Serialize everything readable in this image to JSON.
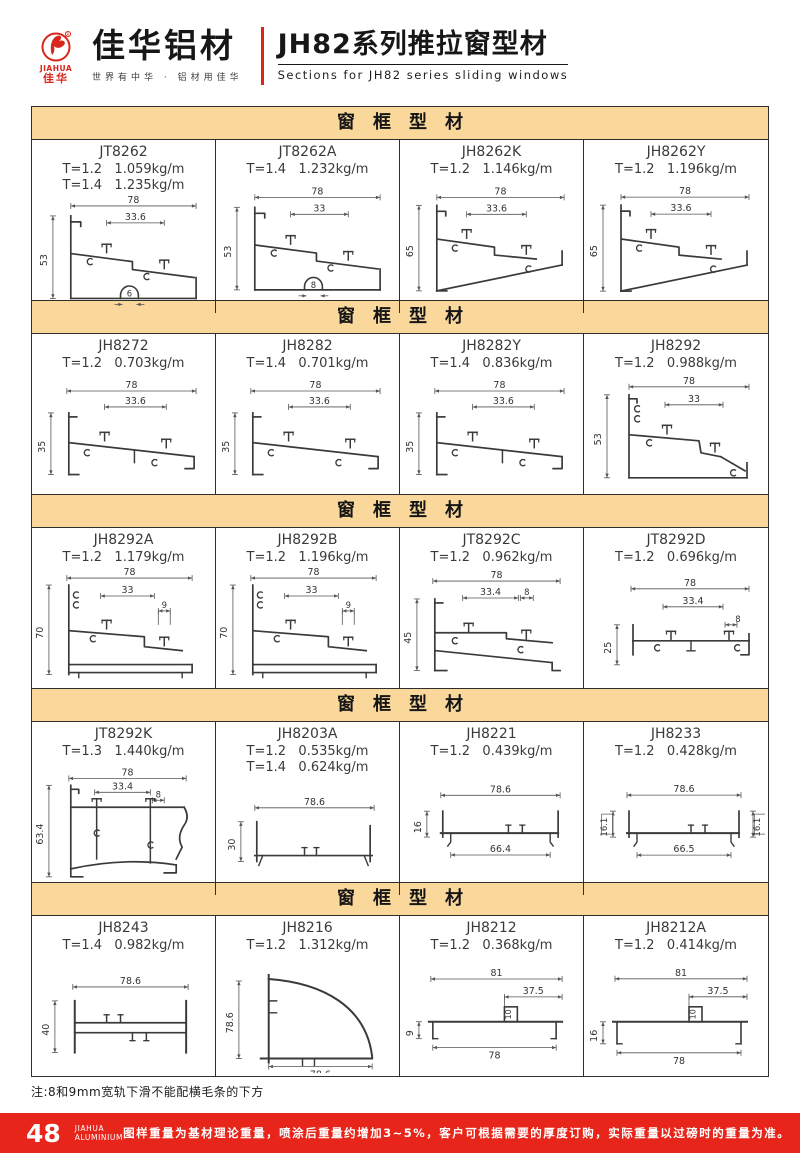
{
  "header": {
    "logo": {
      "mark": "JIAHUA",
      "seal": "佳华",
      "brand": "佳华铝材",
      "tagline": "世界有中华 · 铝材用佳华"
    },
    "title_cn": "JH82系列推拉窗型材",
    "title_en": "Sections for JH82 series sliding windows"
  },
  "sections": [
    {
      "banner": "窗框型材",
      "profiles": [
        {
          "model": "JT8262",
          "weights": [
            "T=1.2   1.059kg/m",
            "T=1.4   1.235kg/m"
          ],
          "shape": "sill53",
          "dims": {
            "w": "78",
            "inner": "33.6",
            "h": "53",
            "slot": "6"
          }
        },
        {
          "model": "JT8262A",
          "weights": [
            "T=1.4   1.232kg/m"
          ],
          "shape": "sill53",
          "dims": {
            "w": "78",
            "inner": "33",
            "h": "53",
            "slot": "8"
          }
        },
        {
          "model": "JH8262K",
          "weights": [
            "T=1.2   1.146kg/m"
          ],
          "shape": "frame65",
          "dims": {
            "w": "78",
            "inner": "33.6",
            "h": "65"
          }
        },
        {
          "model": "JH8262Y",
          "weights": [
            "T=1.2   1.196kg/m"
          ],
          "shape": "frame65",
          "dims": {
            "w": "78",
            "inner": "33.6",
            "h": "65"
          }
        }
      ]
    },
    {
      "banner": "窗框型材",
      "profiles": [
        {
          "model": "JH8272",
          "weights": [
            "T=1.2   0.703kg/m"
          ],
          "shape": "frame35",
          "dims": {
            "w": "78",
            "inner": "33.6",
            "h": "35",
            "stub": "1"
          }
        },
        {
          "model": "JH8282",
          "weights": [
            "T=1.4   0.701kg/m"
          ],
          "shape": "frame35",
          "dims": {
            "w": "78",
            "inner": "33.6",
            "h": "35"
          }
        },
        {
          "model": "JH8282Y",
          "weights": [
            "T=1.4   0.836kg/m"
          ],
          "shape": "frame35",
          "dims": {
            "w": "78",
            "inner": "33.6",
            "h": "35",
            "stub": "1"
          }
        },
        {
          "model": "JH8292",
          "weights": [
            "T=1.2   0.988kg/m"
          ],
          "shape": "frame53b",
          "dims": {
            "w": "78",
            "inner": "33",
            "h": "53"
          }
        }
      ]
    },
    {
      "banner": "窗框型材",
      "profiles": [
        {
          "model": "JH8292A",
          "weights": [
            "T=1.2   1.179kg/m"
          ],
          "shape": "frame70",
          "dims": {
            "w": "78",
            "inner": "33",
            "sub": "9",
            "h": "70"
          }
        },
        {
          "model": "JH8292B",
          "weights": [
            "T=1.2   1.196kg/m"
          ],
          "shape": "frame70",
          "dims": {
            "w": "78",
            "inner": "33",
            "sub": "9",
            "h": "70"
          }
        },
        {
          "model": "JT8292C",
          "weights": [
            "T=1.2   0.962kg/m"
          ],
          "shape": "frame45",
          "dims": {
            "w": "78",
            "inner": "33.4",
            "sub": "8",
            "h": "45"
          }
        },
        {
          "model": "JT8292D",
          "weights": [
            "T=1.2   0.696kg/m"
          ],
          "shape": "frame25",
          "dims": {
            "w": "78",
            "inner": "33.4",
            "sub": "8",
            "h": "25"
          }
        }
      ]
    },
    {
      "banner": "窗框型材",
      "profiles": [
        {
          "model": "JT8292K",
          "weights": [
            "T=1.3   1.440kg/m"
          ],
          "shape": "frame63",
          "dims": {
            "w": "78",
            "inner": "33.4",
            "sub": "8",
            "h": "63.4"
          }
        },
        {
          "model": "JH8203A",
          "weights": [
            "T=1.2   0.535kg/m",
            "T=1.4   0.624kg/m"
          ],
          "shape": "channel30",
          "dims": {
            "w": "78.6",
            "h": "30"
          }
        },
        {
          "model": "JH8221",
          "weights": [
            "T=1.2   0.439kg/m"
          ],
          "shape": "channel16",
          "dims": {
            "w": "78.6",
            "h": "16",
            "b": "66.4"
          }
        },
        {
          "model": "JH8233",
          "weights": [
            "T=1.2   0.428kg/m"
          ],
          "shape": "channel16x2",
          "dims": {
            "w": "78.6",
            "h": "16.1",
            "h2": "16.1",
            "b": "66.5"
          }
        }
      ]
    },
    {
      "banner": "窗框型材",
      "profiles": [
        {
          "model": "JH8243",
          "weights": [
            "T=1.4   0.982kg/m"
          ],
          "shape": "ibeam40",
          "dims": {
            "w": "78.6",
            "h": "40"
          }
        },
        {
          "model": "JH8216",
          "weights": [
            "T=1.2   1.312kg/m"
          ],
          "shape": "quarter",
          "dims": {
            "h": "78.6",
            "b": "78.6"
          }
        },
        {
          "model": "JH8212",
          "weights": [
            "T=1.2   0.368kg/m"
          ],
          "shape": "rail",
          "dims": {
            "w": "81",
            "t": "37.5",
            "blk": "10",
            "h": "9",
            "b": "78",
            "foot": "18"
          }
        },
        {
          "model": "JH8212A",
          "weights": [
            "T=1.2   0.414kg/m"
          ],
          "shape": "rail",
          "dims": {
            "w": "81",
            "t": "37.5",
            "blk": "10",
            "h": "16",
            "b": "78",
            "foot": "24"
          }
        }
      ]
    }
  ],
  "note": "注:8和9mm宽轨下滑不能配横毛条的下方",
  "footer": {
    "page": "48",
    "brand1": "JIAHUA",
    "brand2": "ALUMINIUM",
    "disclaimer": "图样重量为基材理论重量，喷涂后重量约增加3~5%，客户可根据需要的厚度订购，实际重量以过磅时的重量为准。"
  }
}
